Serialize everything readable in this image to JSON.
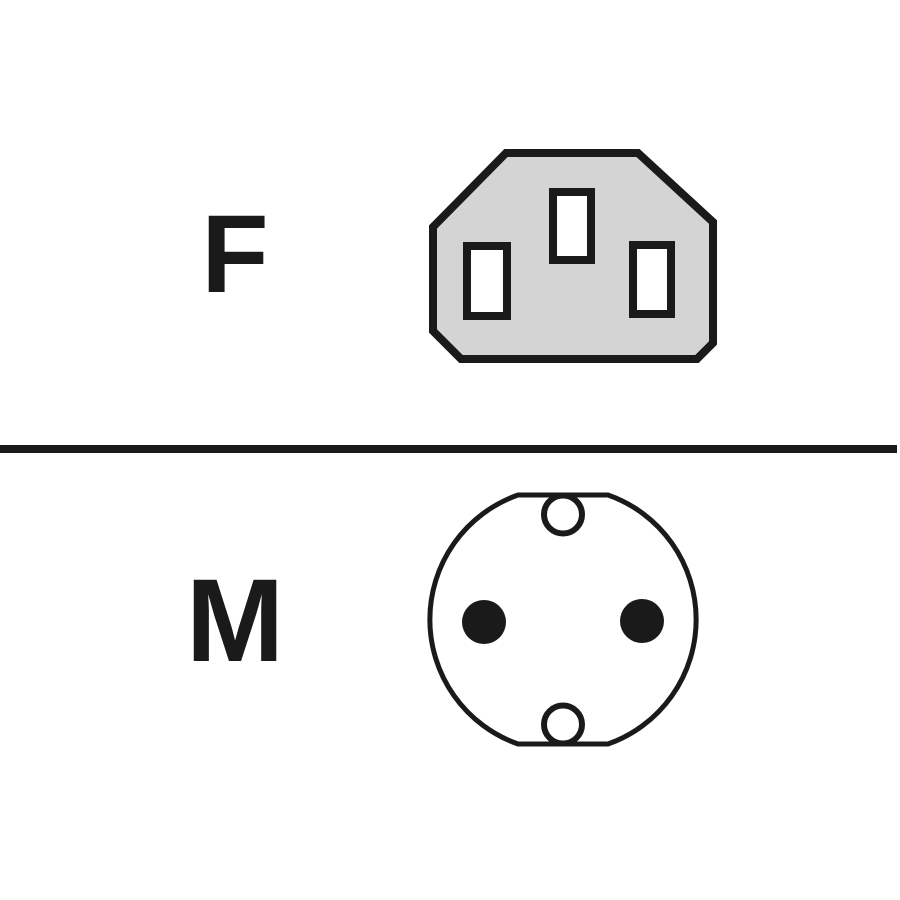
{
  "diagram": {
    "female": {
      "label": "F",
      "icon": "iec-c13-female-connector-icon",
      "description": "female connector face with three rectangular pin slots"
    },
    "male": {
      "label": "M",
      "icon": "round-two-pin-male-connector-icon",
      "description": "round male connector face with two pins and ground clip holes"
    },
    "colors": {
      "ink": "#1a1a1a",
      "connector_fill": "#d4d4d4",
      "paper": "#ffffff"
    }
  }
}
